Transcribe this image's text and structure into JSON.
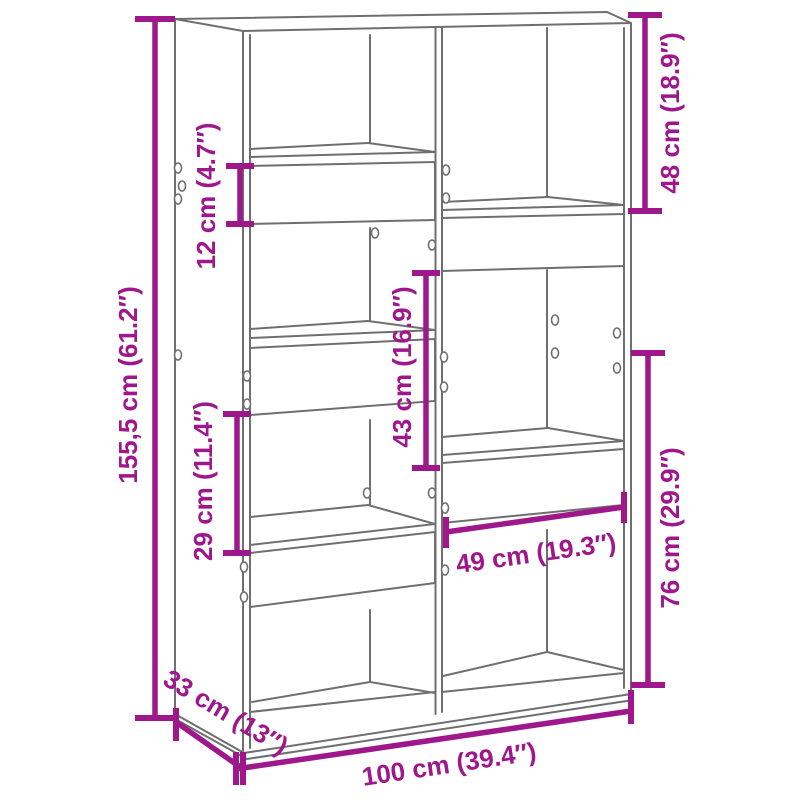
{
  "diagram": {
    "type": "furniture-dimension-diagram",
    "product": "bookcase-room-divider",
    "colors": {
      "dimension_accent": "#9E188C",
      "drawing_outline": "#6F6F6F",
      "background": "#FFFFFF"
    },
    "dimensions": {
      "total_height": {
        "label": "155,5 cm (61.2″)"
      },
      "backer_height_12": {
        "label": "12 cm (4.7″)"
      },
      "top_right_48": {
        "label": "48 cm (18.9″)"
      },
      "middle_43": {
        "label": "43 cm (16.9″)"
      },
      "left_lower_29": {
        "label": "29 cm (11.4″)"
      },
      "right_lower_76": {
        "label": "76 cm (29.9″)"
      },
      "inner_width_49": {
        "label": "49 cm (19.3″)"
      },
      "depth_33": {
        "label": "33 cm (13″)"
      },
      "total_width_100": {
        "label": "100 cm (39.4″)"
      }
    }
  }
}
